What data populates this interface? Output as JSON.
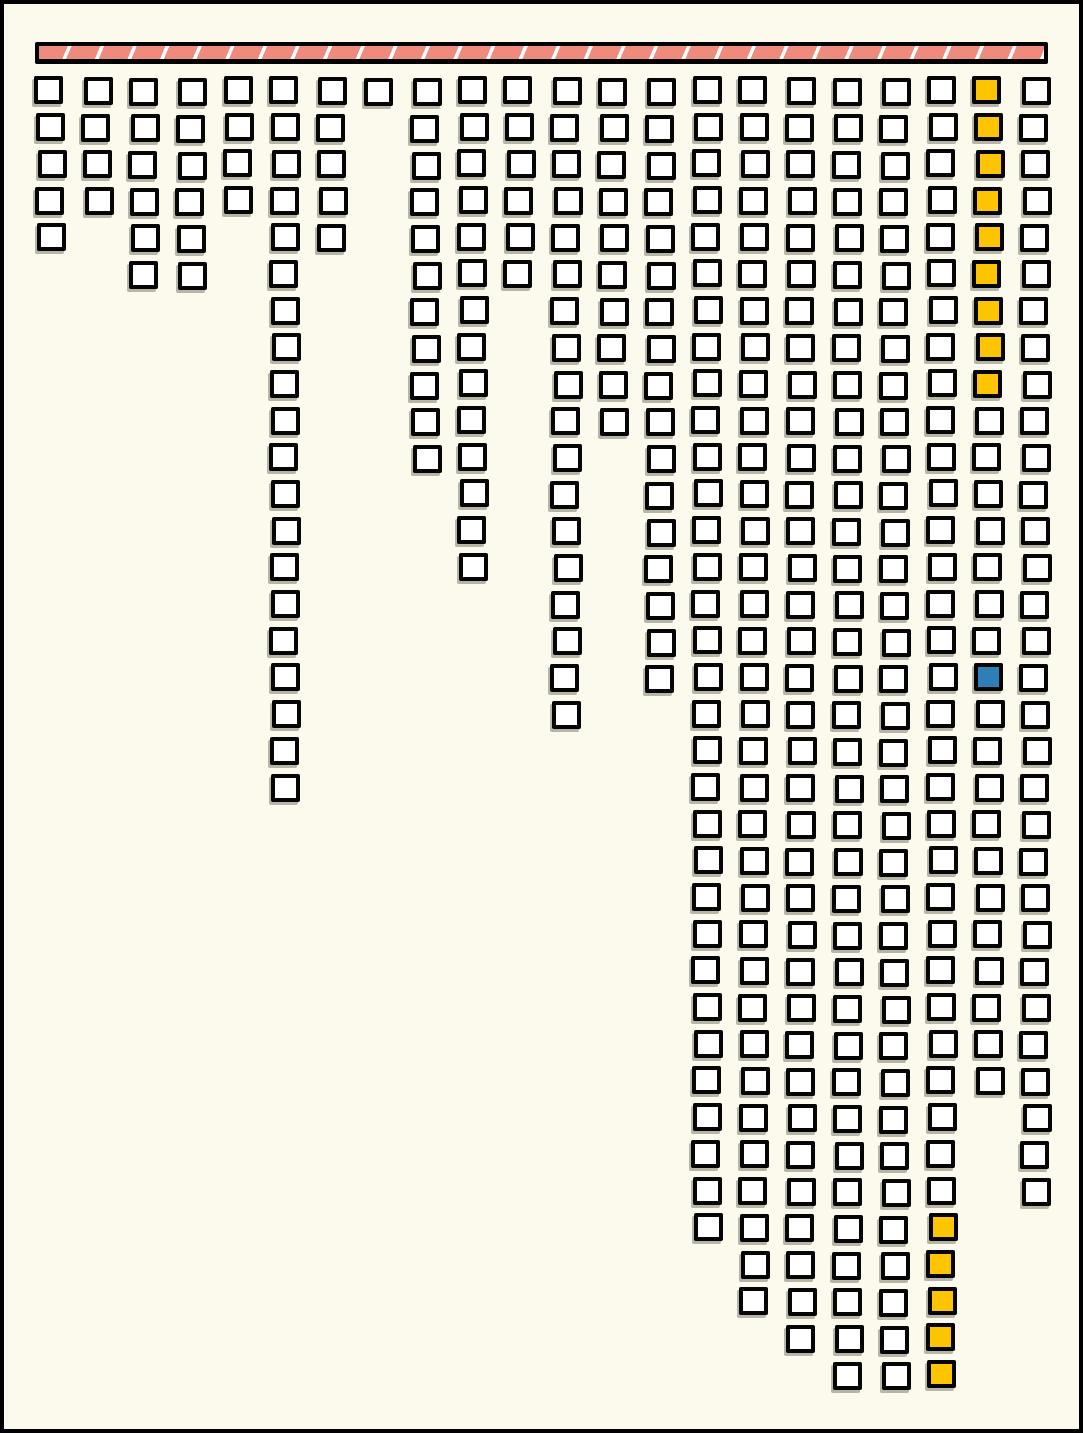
{
  "canvas": {
    "width": 1083,
    "height": 1433,
    "background_color": "#FCFAEC",
    "frame_color": "#000000"
  },
  "header_bar": {
    "description": "hatched horizontal bar across the top from which the square columns hang",
    "fill_color": "#EF8B7C",
    "divider_color": "#FFFFFF",
    "border_color": "#000000",
    "segments": 31,
    "slash_direction": "forward-slash"
  },
  "colors": {
    "square_fill": "#FFFFFF",
    "square_border": "#050505",
    "highlight_yellow": "#FDC500",
    "highlight_blue": "#2E7EB8",
    "shadow": "rgba(100,98,84,0.45)"
  },
  "chart_data": {
    "type": "bar",
    "subtype": "unit-square waffle columns descending from a top bar",
    "title": "",
    "xlabel": "",
    "ylabel": "",
    "legend": null,
    "categories": [
      1,
      2,
      3,
      4,
      5,
      6,
      7,
      8,
      9,
      10,
      11,
      12,
      13,
      14,
      15,
      16,
      17,
      18,
      19,
      20,
      21,
      22
    ],
    "values": [
      5,
      4,
      6,
      6,
      4,
      20,
      5,
      1,
      11,
      14,
      6,
      18,
      10,
      17,
      32,
      34,
      35,
      36,
      36,
      36,
      28,
      31
    ],
    "grid": {
      "columns": 22,
      "max_rows": 36
    },
    "total_units": 395,
    "unit_colors": {
      "default": "#FFFFFF",
      "yellow": "#FDC500",
      "blue": "#2E7EB8"
    },
    "highlights": [
      {
        "color": "yellow",
        "col": 21,
        "rows": [
          1,
          2,
          3,
          4,
          5,
          6,
          7,
          8,
          9
        ]
      },
      {
        "color": "blue",
        "col": 21,
        "rows": [
          17
        ]
      },
      {
        "color": "yellow",
        "col": 20,
        "rows": [
          32,
          33,
          34,
          35,
          36
        ]
      }
    ]
  }
}
